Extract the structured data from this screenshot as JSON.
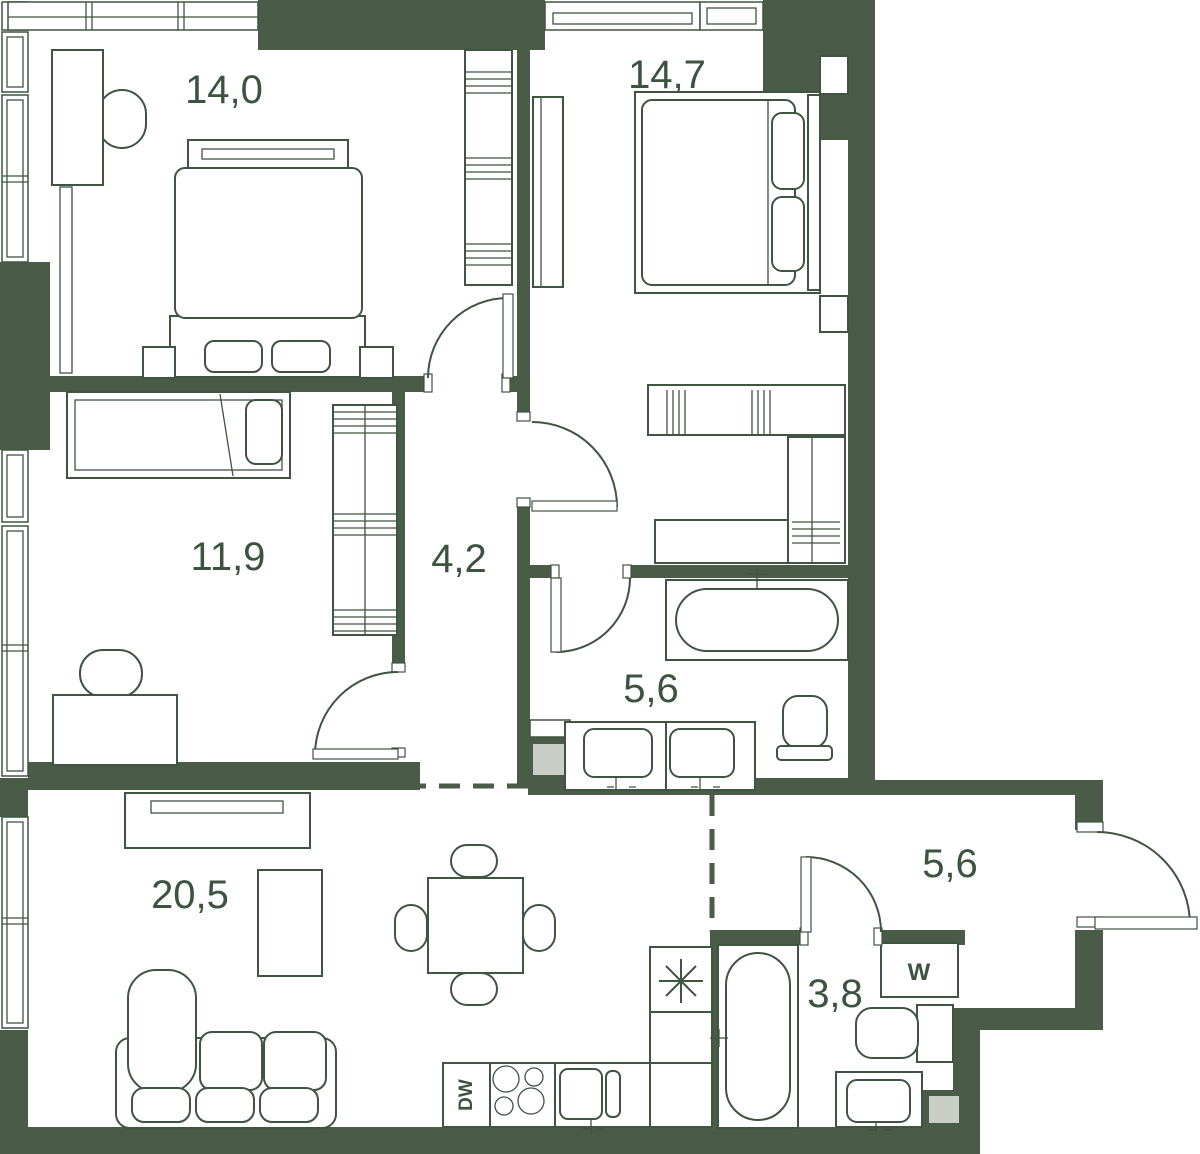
{
  "plan": {
    "type": "apartment-floor-plan",
    "colors": {
      "wall": "#4a5b48",
      "furniture_line": "#3f5441",
      "shaft_fill": "#c9cec6",
      "label_text": "#3c5340",
      "background": "#ffffff"
    },
    "rooms": [
      {
        "name": "bedroom-main",
        "area": "14,0"
      },
      {
        "name": "bedroom-second",
        "area": "14,7"
      },
      {
        "name": "bedroom-kids",
        "area": "11,9"
      },
      {
        "name": "hallway-inner",
        "area": "4,2"
      },
      {
        "name": "bathroom-family",
        "area": "5,6"
      },
      {
        "name": "living-kitchen",
        "area": "20,5"
      },
      {
        "name": "entry-hall",
        "area": "5,6"
      },
      {
        "name": "bathroom-guest",
        "area": "3,8"
      }
    ],
    "labels": {
      "dishwasher": "DW",
      "washer": "W"
    }
  }
}
